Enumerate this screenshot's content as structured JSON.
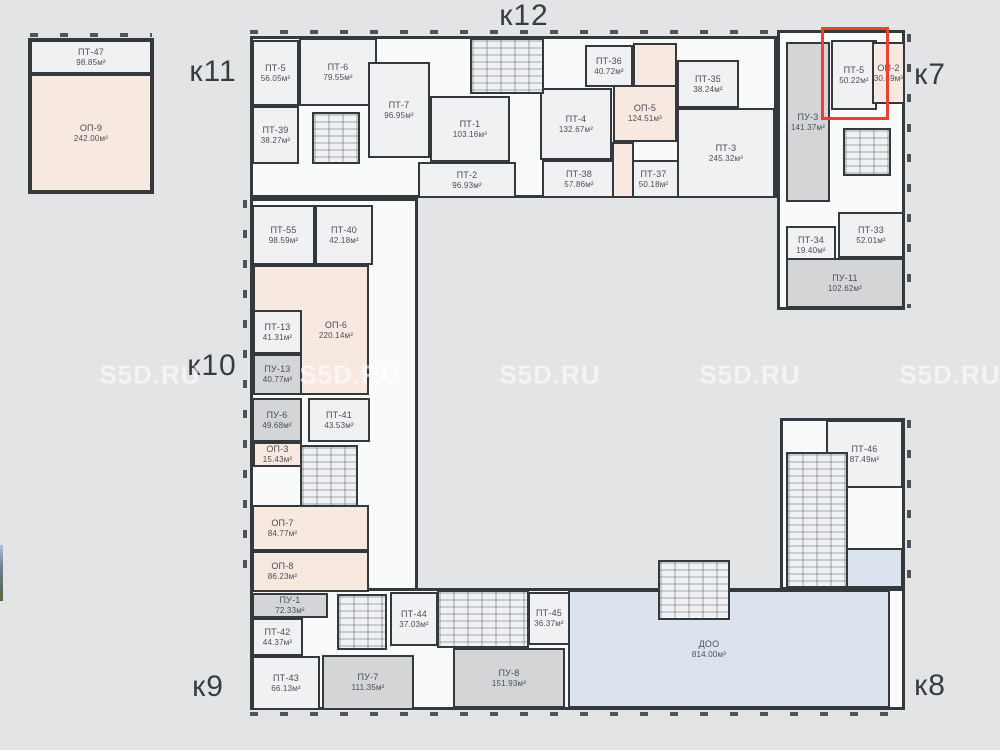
{
  "page": {
    "title_watermark": "S5D.RU"
  },
  "colors": {
    "background": "#e3e4e5",
    "wall": "#35383d",
    "unit_white": "#f0f1f2",
    "unit_pink": "#f7e8e0",
    "unit_gray": "#d3d5d7",
    "unit_blue": "#dbe4ee",
    "corridor": "#f9fafa",
    "highlight": "#e8432e",
    "room_label": "#4a4e54",
    "building_label": "#393d43"
  },
  "building_labels": [
    {
      "id": "k11",
      "text": "к11",
      "x": 213,
      "y": 72
    },
    {
      "id": "k12",
      "text": "к12",
      "x": 524,
      "y": 16
    },
    {
      "id": "k7",
      "text": "к7",
      "x": 930,
      "y": 75
    },
    {
      "id": "k10",
      "text": "к10",
      "x": 212,
      "y": 366
    },
    {
      "id": "k9",
      "text": "к9",
      "x": 208,
      "y": 687
    },
    {
      "id": "k8",
      "text": "к8",
      "x": 930,
      "y": 686
    }
  ],
  "watermarks": {
    "text": "S5D.RU",
    "positions": [
      {
        "x": 150,
        "y": 375
      },
      {
        "x": 350,
        "y": 375
      },
      {
        "x": 550,
        "y": 375
      },
      {
        "x": 750,
        "y": 375
      },
      {
        "x": 950,
        "y": 375
      }
    ]
  },
  "highlight": {
    "unit": "ПТ-5",
    "area": "50.22м²",
    "x": 821,
    "y": 27,
    "w": 68,
    "h": 93
  },
  "outlines": [
    {
      "id": "block-topleft",
      "x": 28,
      "y": 38,
      "w": 126,
      "h": 156
    },
    {
      "id": "band-top",
      "x": 250,
      "y": 36,
      "w": 527,
      "h": 162
    },
    {
      "id": "wing-right-top",
      "x": 777,
      "y": 30,
      "w": 128,
      "h": 280
    },
    {
      "id": "wing-left",
      "x": 250,
      "y": 198,
      "w": 168,
      "h": 396
    },
    {
      "id": "band-bottom",
      "x": 250,
      "y": 588,
      "w": 655,
      "h": 122
    },
    {
      "id": "tower-right-bottom",
      "x": 780,
      "y": 418,
      "w": 125,
      "h": 172
    }
  ],
  "rooms": [
    {
      "id": "pt-47",
      "name": "ПТ-47",
      "area": "98.85м²",
      "x": 30,
      "y": 40,
      "w": 122,
      "h": 34,
      "fill": "white"
    },
    {
      "id": "op-9",
      "name": "ОП-9",
      "area": "242.00м²",
      "x": 30,
      "y": 74,
      "w": 122,
      "h": 118,
      "fill": "pink"
    },
    {
      "id": "pt-5",
      "name": "ПТ-5",
      "area": "56.05м²",
      "x": 252,
      "y": 40,
      "w": 47,
      "h": 66,
      "fill": "white"
    },
    {
      "id": "pt-6",
      "name": "ПТ-6",
      "area": "79.55м²",
      "x": 299,
      "y": 38,
      "w": 78,
      "h": 68,
      "fill": "white"
    },
    {
      "id": "pt-39",
      "name": "ПТ-39",
      "area": "38.27м²",
      "x": 252,
      "y": 106,
      "w": 47,
      "h": 58,
      "fill": "white"
    },
    {
      "id": "pt-7",
      "name": "ПТ-7",
      "area": "96.95м²",
      "x": 368,
      "y": 62,
      "w": 62,
      "h": 96,
      "fill": "white"
    },
    {
      "id": "pt-1",
      "name": "ПТ-1",
      "area": "103.16м²",
      "x": 430,
      "y": 96,
      "w": 80,
      "h": 66,
      "fill": "white"
    },
    {
      "id": "pt-2",
      "name": "ПТ-2",
      "area": "96.93м²",
      "x": 418,
      "y": 162,
      "w": 98,
      "h": 36,
      "fill": "white"
    },
    {
      "id": "pt-4",
      "name": "ПТ-4",
      "area": "132.67м²",
      "x": 540,
      "y": 88,
      "w": 72,
      "h": 72,
      "fill": "white"
    },
    {
      "id": "pt-36",
      "name": "ПТ-36",
      "area": "40.72м²",
      "x": 585,
      "y": 45,
      "w": 48,
      "h": 42,
      "fill": "white"
    },
    {
      "id": "op-5",
      "name": "ОП-5",
      "area": "124.51м²",
      "x": 613,
      "y": 85,
      "w": 64,
      "h": 57,
      "fill": "pink"
    },
    {
      "id": "pt-35",
      "name": "ПТ-35",
      "area": "38.24м²",
      "x": 677,
      "y": 60,
      "w": 62,
      "h": 48,
      "fill": "white"
    },
    {
      "id": "pt-38",
      "name": "ПТ-38",
      "area": "57.86м²",
      "x": 542,
      "y": 160,
      "w": 74,
      "h": 38,
      "fill": "white"
    },
    {
      "id": "pt-37",
      "name": "ПТ-37",
      "area": "50.18м²",
      "x": 620,
      "y": 160,
      "w": 67,
      "h": 38,
      "fill": "white"
    },
    {
      "id": "pt-3",
      "name": "ПТ-3",
      "area": "245.32м²",
      "x": 677,
      "y": 108,
      "w": 98,
      "h": 90,
      "fill": "white"
    },
    {
      "id": "pu-3",
      "name": "ПУ-3",
      "area": "141.37м²",
      "x": 786,
      "y": 42,
      "w": 44,
      "h": 160,
      "fill": "gray"
    },
    {
      "id": "pt-5-k7",
      "name": "ПТ-5",
      "area": "50.22м²",
      "x": 831,
      "y": 40,
      "w": 46,
      "h": 70,
      "fill": "white"
    },
    {
      "id": "op-2",
      "name": "ОП-2",
      "area": "30.59м²",
      "x": 872,
      "y": 42,
      "w": 33,
      "h": 62,
      "fill": "pink"
    },
    {
      "id": "pt-33",
      "name": "ПТ-33",
      "area": "52.01м²",
      "x": 838,
      "y": 212,
      "w": 66,
      "h": 46,
      "fill": "white"
    },
    {
      "id": "pt-34",
      "name": "ПТ-34",
      "area": "19.40м²",
      "x": 786,
      "y": 226,
      "w": 50,
      "h": 38,
      "fill": "white"
    },
    {
      "id": "pu-11",
      "name": "ПУ-11",
      "area": "102.62м²",
      "x": 786,
      "y": 258,
      "w": 118,
      "h": 50,
      "fill": "gray"
    },
    {
      "id": "pt-55",
      "name": "ПТ-55",
      "area": "98.59м²",
      "x": 252,
      "y": 205,
      "w": 63,
      "h": 60,
      "fill": "white"
    },
    {
      "id": "pt-40",
      "name": "ПТ-40",
      "area": "42.18м²",
      "x": 315,
      "y": 205,
      "w": 58,
      "h": 60,
      "fill": "white"
    },
    {
      "id": "op-6",
      "name": "ОП-6",
      "area": "220.14м²",
      "x": 253,
      "y": 265,
      "w": 116,
      "h": 130,
      "fill": "pink",
      "lox": 25
    },
    {
      "id": "pt-13",
      "name": "ПТ-13",
      "area": "41.31м²",
      "x": 253,
      "y": 310,
      "w": 49,
      "h": 44,
      "fill": "white"
    },
    {
      "id": "pu-13",
      "name": "ПУ-13",
      "area": "40.77м²",
      "x": 253,
      "y": 354,
      "w": 49,
      "h": 41,
      "fill": "gray"
    },
    {
      "id": "pu-6",
      "name": "ПУ-6",
      "area": "49.68м²",
      "x": 252,
      "y": 398,
      "w": 50,
      "h": 44,
      "fill": "gray"
    },
    {
      "id": "pt-41",
      "name": "ПТ-41",
      "area": "43.53м²",
      "x": 308,
      "y": 398,
      "w": 62,
      "h": 44,
      "fill": "white"
    },
    {
      "id": "op-3",
      "name": "ОП-3",
      "area": "15.43м²",
      "x": 253,
      "y": 442,
      "w": 49,
      "h": 25,
      "fill": "pink"
    },
    {
      "id": "op-7",
      "name": "ОП-7",
      "area": "84.77м²",
      "x": 252,
      "y": 505,
      "w": 117,
      "h": 46,
      "fill": "pink",
      "lox": -28
    },
    {
      "id": "op-8",
      "name": "ОП-8",
      "area": "86.23м²",
      "x": 252,
      "y": 551,
      "w": 117,
      "h": 41,
      "fill": "pink",
      "lox": -28
    },
    {
      "id": "pu-1",
      "name": "ПУ-1",
      "area": "72.33м²",
      "x": 252,
      "y": 593,
      "w": 76,
      "h": 25,
      "fill": "gray"
    },
    {
      "id": "pt-42",
      "name": "ПТ-42",
      "area": "44.37м²",
      "x": 252,
      "y": 618,
      "w": 51,
      "h": 38,
      "fill": "white"
    },
    {
      "id": "pt-43",
      "name": "ПТ-43",
      "area": "66.13м²",
      "x": 252,
      "y": 656,
      "w": 68,
      "h": 54,
      "fill": "white"
    },
    {
      "id": "pu-7",
      "name": "ПУ-7",
      "area": "111.35м²",
      "x": 322,
      "y": 655,
      "w": 92,
      "h": 55,
      "fill": "gray"
    },
    {
      "id": "pt-44",
      "name": "ПТ-44",
      "area": "37.03м²",
      "x": 390,
      "y": 592,
      "w": 48,
      "h": 54,
      "fill": "white"
    },
    {
      "id": "pt-45",
      "name": "ПТ-45",
      "area": "36.37м²",
      "x": 528,
      "y": 592,
      "w": 42,
      "h": 53,
      "fill": "white"
    },
    {
      "id": "pu-8",
      "name": "ПУ-8",
      "area": "151.93м²",
      "x": 453,
      "y": 648,
      "w": 112,
      "h": 60,
      "fill": "gray"
    },
    {
      "id": "doo",
      "name": "ДОО",
      "area": "814.00м²",
      "x": 568,
      "y": 590,
      "w": 322,
      "h": 118,
      "fill": "blue",
      "lox": -20
    },
    {
      "id": "pt-46",
      "name": "ПТ-46",
      "area": "87.49м²",
      "x": 826,
      "y": 420,
      "w": 77,
      "h": 68,
      "fill": "white"
    }
  ],
  "annexes": [
    {
      "x": 633,
      "y": 43,
      "w": 44,
      "h": 44,
      "fill": "pink"
    },
    {
      "x": 612,
      "y": 142,
      "w": 22,
      "h": 56,
      "fill": "pink"
    },
    {
      "x": 845,
      "y": 548,
      "w": 58,
      "h": 40,
      "fill": "blue"
    }
  ],
  "cores": [
    {
      "x": 312,
      "y": 112,
      "w": 48,
      "h": 52
    },
    {
      "x": 470,
      "y": 38,
      "w": 74,
      "h": 56
    },
    {
      "x": 843,
      "y": 128,
      "w": 48,
      "h": 48
    },
    {
      "x": 300,
      "y": 445,
      "w": 58,
      "h": 62
    },
    {
      "x": 337,
      "y": 594,
      "w": 50,
      "h": 56
    },
    {
      "x": 437,
      "y": 590,
      "w": 92,
      "h": 58
    },
    {
      "x": 786,
      "y": 452,
      "w": 62,
      "h": 136
    },
    {
      "x": 658,
      "y": 560,
      "w": 72,
      "h": 60
    }
  ]
}
